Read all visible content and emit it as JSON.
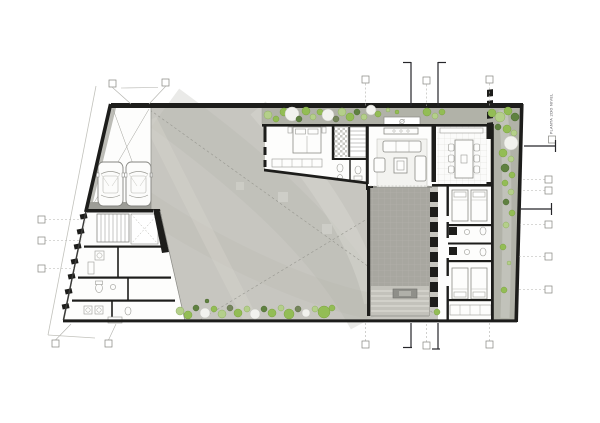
{
  "drawing": {
    "side_label": "PLANTA 2DO NIVEL"
  },
  "colors": {
    "wall": "#1d1d1b",
    "gray_wall": "#90908a",
    "room": "#fdfdfc",
    "concrete": "#c7c6c0",
    "concrete_dark": "#b4b3ab",
    "concrete_light": "#d6d5ce",
    "planting": "#b1b2a8",
    "deck": "#a8a7a0",
    "deck_light": "#c6c5be",
    "green1": "#93bd55",
    "green2": "#b4cf8a",
    "green3": "#5f8140",
    "green_dark": "#74855a",
    "white_tree": "#f2f2ee"
  },
  "vegetation": {
    "trees": [
      [
        268,
        115,
        4,
        "g2"
      ],
      [
        276,
        119,
        3,
        "g1"
      ],
      [
        284,
        112,
        4,
        "g1"
      ],
      [
        292,
        114,
        7,
        "gw"
      ],
      [
        299,
        119,
        3,
        "g3"
      ],
      [
        306,
        111,
        4,
        "g1"
      ],
      [
        313,
        117,
        3,
        "g2"
      ],
      [
        320,
        112,
        3,
        "g1"
      ],
      [
        328,
        115,
        6,
        "gw"
      ],
      [
        336,
        119,
        3,
        "gd"
      ],
      [
        342,
        112,
        4,
        "g2"
      ],
      [
        350,
        117,
        4,
        "g1"
      ],
      [
        357,
        112,
        3,
        "g3"
      ],
      [
        364,
        117,
        3,
        "g2"
      ],
      [
        371,
        110,
        5,
        "gw"
      ],
      [
        378,
        114,
        3,
        "g1"
      ],
      [
        388,
        110,
        2,
        "g2"
      ],
      [
        397,
        112,
        2,
        "g1"
      ],
      [
        427,
        112,
        4,
        "g1"
      ],
      [
        435,
        116,
        3,
        "g2"
      ],
      [
        442,
        112,
        3,
        "g1"
      ],
      [
        492,
        113,
        4,
        "g1"
      ],
      [
        500,
        117,
        5,
        "g2"
      ],
      [
        508,
        111,
        4,
        "g1"
      ],
      [
        515,
        117,
        4,
        "g3"
      ],
      [
        498,
        127,
        3,
        "g3"
      ],
      [
        507,
        129,
        4,
        "g1"
      ],
      [
        514,
        133,
        3,
        "g2"
      ],
      [
        511,
        143,
        7,
        "gw"
      ],
      [
        503,
        153,
        4,
        "g1"
      ],
      [
        511,
        159,
        3,
        "g2"
      ],
      [
        505,
        168,
        4,
        "g3"
      ],
      [
        512,
        175,
        3,
        "g1"
      ],
      [
        505,
        183,
        3,
        "g1"
      ],
      [
        511,
        192,
        3,
        "g2"
      ],
      [
        506,
        202,
        3,
        "g3"
      ],
      [
        512,
        213,
        3,
        "g1"
      ],
      [
        506,
        225,
        3,
        "g2"
      ],
      [
        503,
        247,
        3,
        "g1"
      ],
      [
        509,
        263,
        2,
        "g2"
      ],
      [
        504,
        290,
        3,
        "g1"
      ],
      [
        437,
        312,
        3,
        "g1"
      ],
      [
        180,
        311,
        4,
        "g2"
      ],
      [
        188,
        315,
        4,
        "g1"
      ],
      [
        196,
        308,
        3,
        "g3"
      ],
      [
        205,
        313,
        5,
        "gw"
      ],
      [
        214,
        309,
        3,
        "g1"
      ],
      [
        222,
        314,
        4,
        "g2"
      ],
      [
        230,
        308,
        3,
        "gd"
      ],
      [
        238,
        313,
        4,
        "g1"
      ],
      [
        247,
        309,
        3,
        "g2"
      ],
      [
        255,
        314,
        5,
        "gw"
      ],
      [
        264,
        309,
        3,
        "g3"
      ],
      [
        272,
        313,
        4,
        "g1"
      ],
      [
        281,
        308,
        3,
        "g2"
      ],
      [
        289,
        314,
        5,
        "g1"
      ],
      [
        298,
        309,
        3,
        "gd"
      ],
      [
        306,
        313,
        4,
        "gw"
      ],
      [
        315,
        309,
        3,
        "g2"
      ],
      [
        324,
        312,
        6,
        "g1"
      ],
      [
        332,
        308,
        3,
        "g1"
      ],
      [
        207,
        301,
        2,
        "g3"
      ]
    ]
  },
  "grid_markers": [
    {
      "bx": 362,
      "by": 76,
      "leader": [
        365.5,
        83.5,
        365.5,
        106
      ],
      "style": "dash"
    },
    {
      "bx": 423,
      "by": 77,
      "leader": [
        426.5,
        84.5,
        426.5,
        106
      ],
      "style": "dash"
    },
    {
      "bx": 486,
      "by": 76,
      "leader": [
        489.5,
        83.5,
        489.5,
        106
      ],
      "style": "dash"
    },
    {
      "bx": 109,
      "by": 80,
      "leader": [
        112.5,
        87.5,
        131,
        104
      ],
      "style": "solid"
    },
    {
      "bx": 162,
      "by": 79,
      "leader": [
        165.5,
        86.5,
        149,
        104
      ],
      "style": "solid"
    },
    {
      "bx": 362,
      "by": 341,
      "leader": [
        365.5,
        341,
        365.5,
        323
      ],
      "style": "dash"
    },
    {
      "bx": 423,
      "by": 342,
      "leader": [
        426.5,
        342,
        426.5,
        323
      ],
      "style": "dash"
    },
    {
      "bx": 486,
      "by": 341,
      "leader": [
        489.5,
        341,
        489.5,
        323
      ],
      "style": "dash"
    },
    {
      "bx": 52,
      "by": 340,
      "leader": [
        55.5,
        340,
        71,
        324
      ],
      "style": "solid"
    },
    {
      "bx": 105,
      "by": 340,
      "leader": [
        108.5,
        340,
        116,
        324
      ],
      "style": "solid"
    },
    {
      "bx": 545,
      "by": 176,
      "leader": [
        545,
        179.5,
        521,
        179.5
      ],
      "style": "dash"
    },
    {
      "bx": 545,
      "by": 187,
      "leader": [
        545,
        190.5,
        521,
        190.5
      ],
      "style": "dash"
    },
    {
      "bx": 545,
      "by": 221,
      "leader": [
        545,
        224.5,
        520,
        224.5
      ],
      "style": "dash"
    },
    {
      "bx": 545,
      "by": 253,
      "leader": [
        545,
        256.5,
        519,
        256.5
      ],
      "style": "dash"
    },
    {
      "bx": 545,
      "by": 286,
      "leader": [
        545,
        289.5,
        519,
        289.5
      ],
      "style": "dash"
    },
    {
      "bx": 38,
      "by": 216,
      "leader": [
        45,
        219.5,
        84,
        219.5
      ],
      "style": "dash"
    },
    {
      "bx": 38,
      "by": 237,
      "leader": [
        45,
        240.5,
        80,
        240.5
      ],
      "style": "dash"
    },
    {
      "bx": 38,
      "by": 265,
      "leader": [
        45,
        268.5,
        74,
        268.5
      ],
      "style": "dash"
    },
    {
      "bx": 548.5,
      "by": 136,
      "leader": null,
      "style": "dash"
    }
  ],
  "section_lines": [
    {
      "line": [
        411,
        62,
        411,
        106
      ],
      "tick": [
        403,
        62.5,
        411,
        62.5
      ]
    },
    {
      "line": [
        438,
        62,
        438,
        106
      ],
      "tick": [
        438,
        62.5,
        446,
        62.5
      ]
    },
    {
      "line": [
        411,
        323,
        411,
        348
      ],
      "tick": [
        403,
        347.5,
        412,
        347.5
      ]
    },
    {
      "line": [
        438,
        323,
        438,
        349
      ],
      "tick": [
        432,
        349,
        440,
        349
      ]
    },
    {
      "line": [
        524,
        146,
        556,
        146
      ],
      "tick": [
        555.5,
        140,
        555.5,
        152
      ]
    },
    {
      "line": [
        521,
        209,
        552,
        209
      ],
      "tick": [
        551.5,
        203,
        551.5,
        215
      ]
    }
  ]
}
